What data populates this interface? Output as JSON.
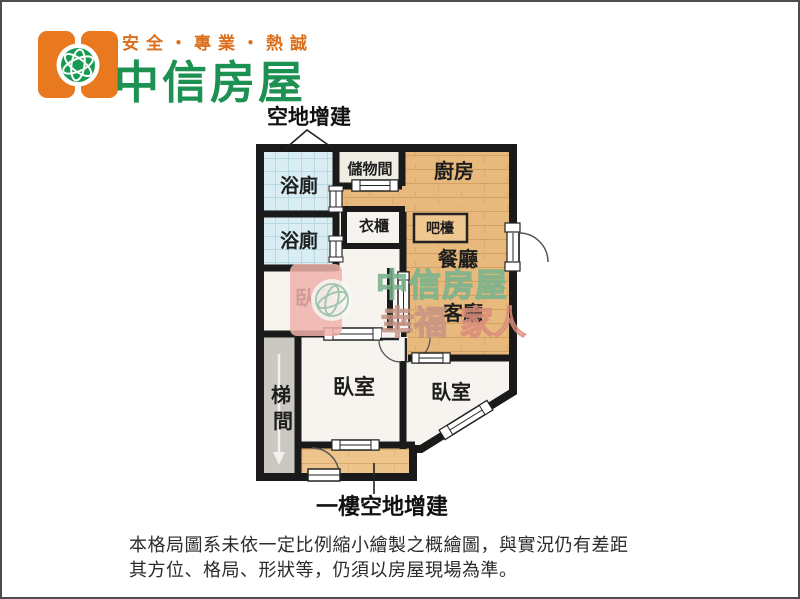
{
  "header": {
    "slogan": "安全・專業・熱誠",
    "brand": "中信房屋"
  },
  "floorplan": {
    "annotation_top": "空地增建",
    "annotation_bottom": "一樓空地增建",
    "rooms": {
      "bath1": "浴廁",
      "bath2": "浴廁",
      "storage": "儲物間",
      "kitchen": "廚房",
      "closet": "衣櫃",
      "bar": "吧檯",
      "dining": "餐廳",
      "living": "客廳",
      "bedroom1": "臥室",
      "bedroom2": "臥室",
      "bedroom3": "臥室",
      "stair_char1": "梯",
      "stair_char2": "間"
    },
    "watermark": {
      "brand": "中信房屋",
      "slogan_left": "幸福",
      "slogan_right": "家人"
    }
  },
  "disclaimer": {
    "line1": "本格局圖系未依一定比例縮小繪製之概繪圖，與實況仍有差距",
    "line2": "其方位、格局、形狀等，仍須以房屋現場為準。"
  },
  "colors": {
    "brand_green": "#1C9151",
    "brand_orange": "#E8791E",
    "slogan_orange": "#DC6E1A",
    "wall": "#1a1a1a",
    "wood_floor": "#E8B97D",
    "tile_blue": "#D9EDF3",
    "stair_gray": "#CBC8C2",
    "room_white": "#F7F4EF",
    "watermark_pink": "#F0B2AA",
    "watermark_green": "#7DB48C"
  }
}
